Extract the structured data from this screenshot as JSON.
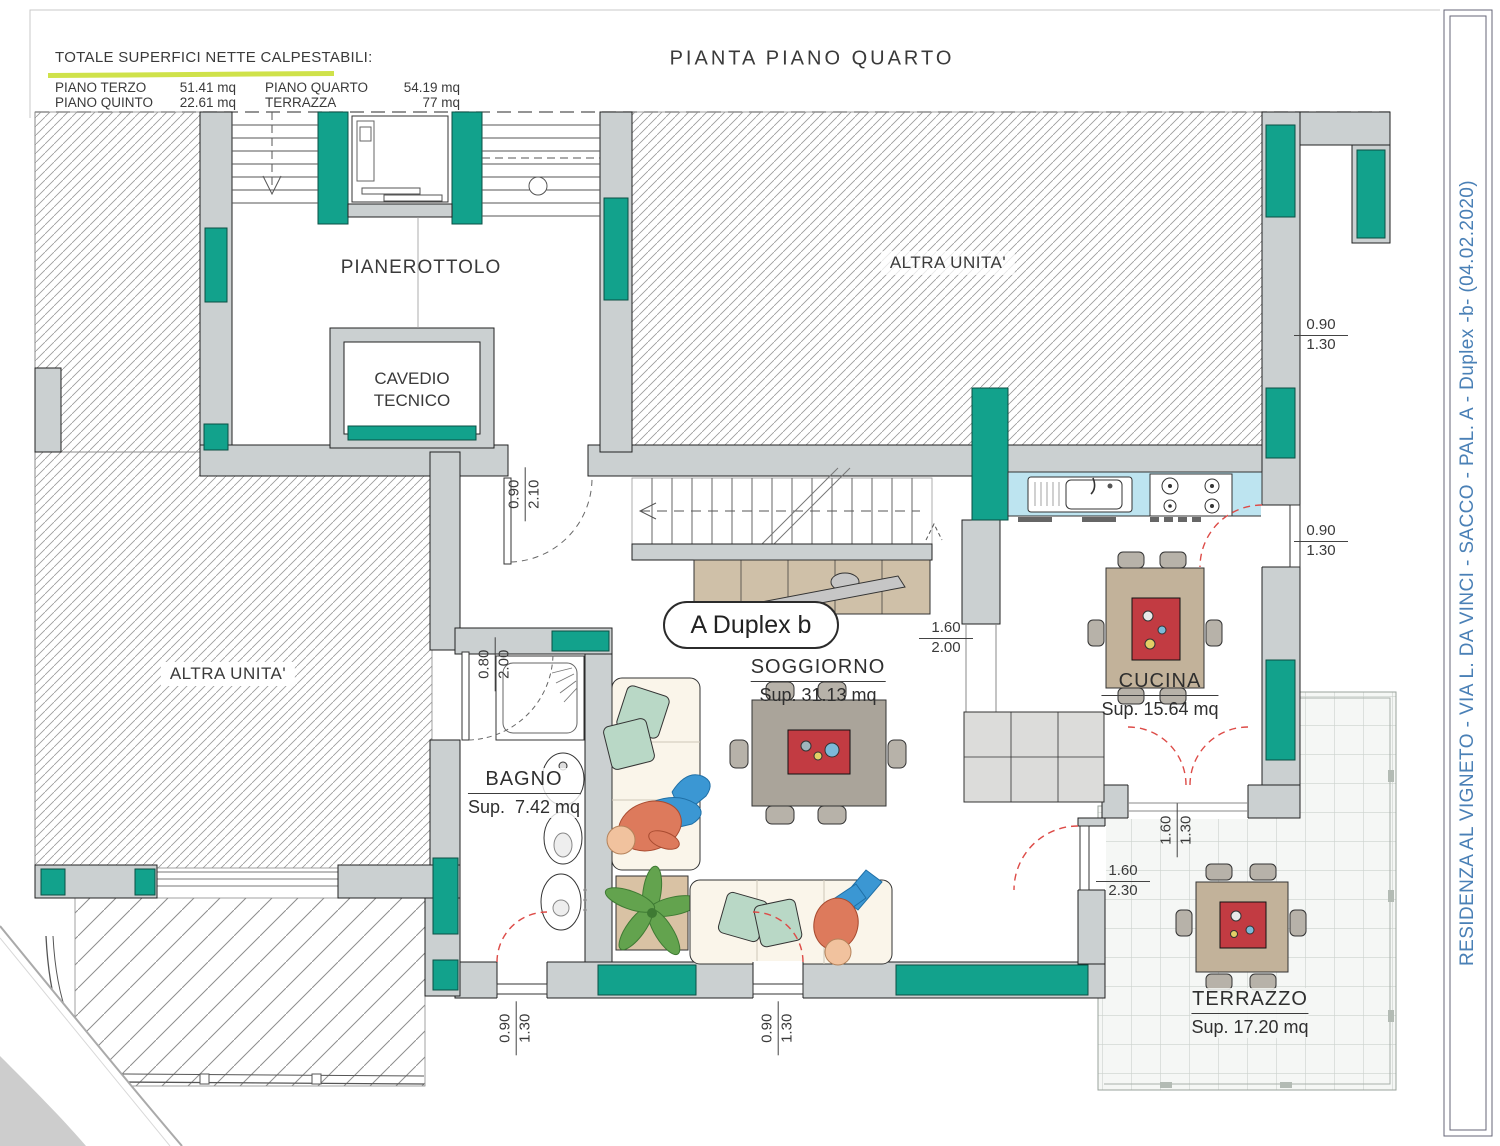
{
  "header": {
    "summary_title": "TOTALE SUPERFICI NETTE CALPESTABILI:",
    "col1": [
      {
        "label": "PIANO TERZO",
        "value": "51.41 mq"
      },
      {
        "label": "PIANO QUINTO",
        "value": "22.61 mq"
      }
    ],
    "col2": [
      {
        "label": "PIANO QUARTO",
        "value": "54.19 mq"
      },
      {
        "label": "TERRAZZA",
        "value": "77 mq"
      }
    ],
    "plan_title": "PIANTA PIANO QUARTO"
  },
  "title_block": {
    "text": "RESIDENZA AL VIGNETO - VIA L. DA VINCI - SACCO - PAL. A - Duplex -b-  (04.02.2020)"
  },
  "unit_badge": "A Duplex b",
  "rooms": {
    "pianerottolo": "PIANEROTTOLO",
    "cavedio_line1": "CAVEDIO",
    "cavedio_line2": "TECNICO",
    "altra_unita_top": "ALTRA UNITA'",
    "altra_unita_left": "ALTRA UNITA'",
    "soggiorno": {
      "name": "SOGGIORNO",
      "sup": "Sup. 31.13 mq"
    },
    "cucina": {
      "name": "CUCINA",
      "sup": "Sup. 15.64 mq"
    },
    "bagno": {
      "name": "BAGNO",
      "sup": "Sup.  7.42 mq"
    },
    "terrazzo": {
      "name": "TERRAZZO",
      "sup": "Sup. 17.20 mq"
    }
  },
  "dimensions": {
    "window_right_top": {
      "a": "0.90",
      "b": "1.30"
    },
    "window_right_mid": {
      "a": "0.90",
      "b": "1.30"
    },
    "passage_cucina": {
      "a": "1.60",
      "b": "2.00"
    },
    "terrace_window": {
      "a": "1.60",
      "b": "1.30"
    },
    "terrace_door": {
      "a": "1.60",
      "b": "2.30"
    },
    "entry_door": {
      "a": "0.90",
      "b": "2.10"
    },
    "bagno_door": {
      "a": "0.80",
      "b": "2.00"
    },
    "balcony_door_left": {
      "a": "0.90",
      "b": "1.30"
    },
    "balcony_door_center": {
      "a": "0.90",
      "b": "1.30"
    }
  },
  "colors": {
    "window_teal": "#12a28c",
    "wall_gray": "#cbd0d1",
    "counter_blue": "#bde4f0",
    "door_arc_red": "#dd4b47",
    "title_blue": "#4a80b6",
    "highlight_yellow": "#cfe24a"
  }
}
